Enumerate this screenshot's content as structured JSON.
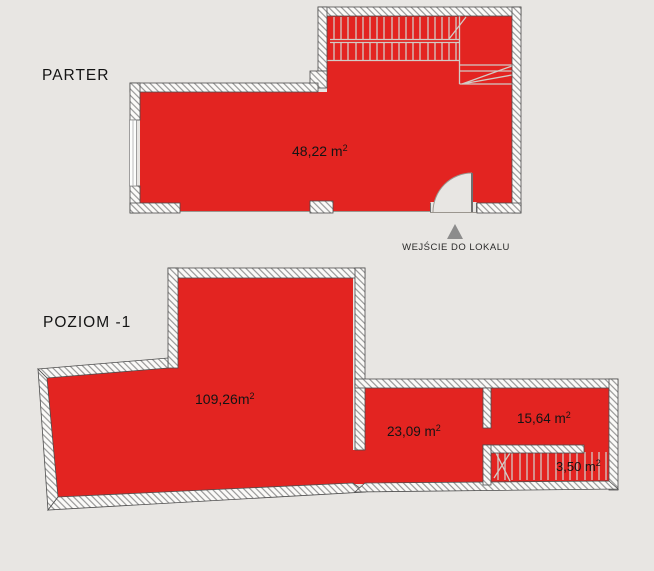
{
  "colors": {
    "background": "#e8e6e3",
    "plan_red": "#e32421",
    "wall_outline": "#4d4d4d",
    "hatch_line": "#858585",
    "stair_line": "#d2cbc5",
    "arrow_gray": "#8c8c8c",
    "label_color": "#141414"
  },
  "floors": {
    "parter": {
      "title": "PARTER",
      "rooms": [
        {
          "name": "main-room",
          "area_value": "48,22 m",
          "area_sup": "2"
        }
      ],
      "entrance": {
        "label": "WEJŚCIE DO LOKALU",
        "arrow_icon": "triangle-up"
      }
    },
    "poziom": {
      "title": "POZIOM -1",
      "rooms": [
        {
          "name": "main-room",
          "area_value": "109,26m",
          "area_sup": "2"
        },
        {
          "name": "room-23",
          "area_value": "23,09 m",
          "area_sup": "2"
        },
        {
          "name": "room-15",
          "area_value": "15,64 m",
          "area_sup": "2"
        },
        {
          "name": "stair-room",
          "area_value": "3,50 m",
          "area_sup": "2"
        }
      ]
    }
  }
}
